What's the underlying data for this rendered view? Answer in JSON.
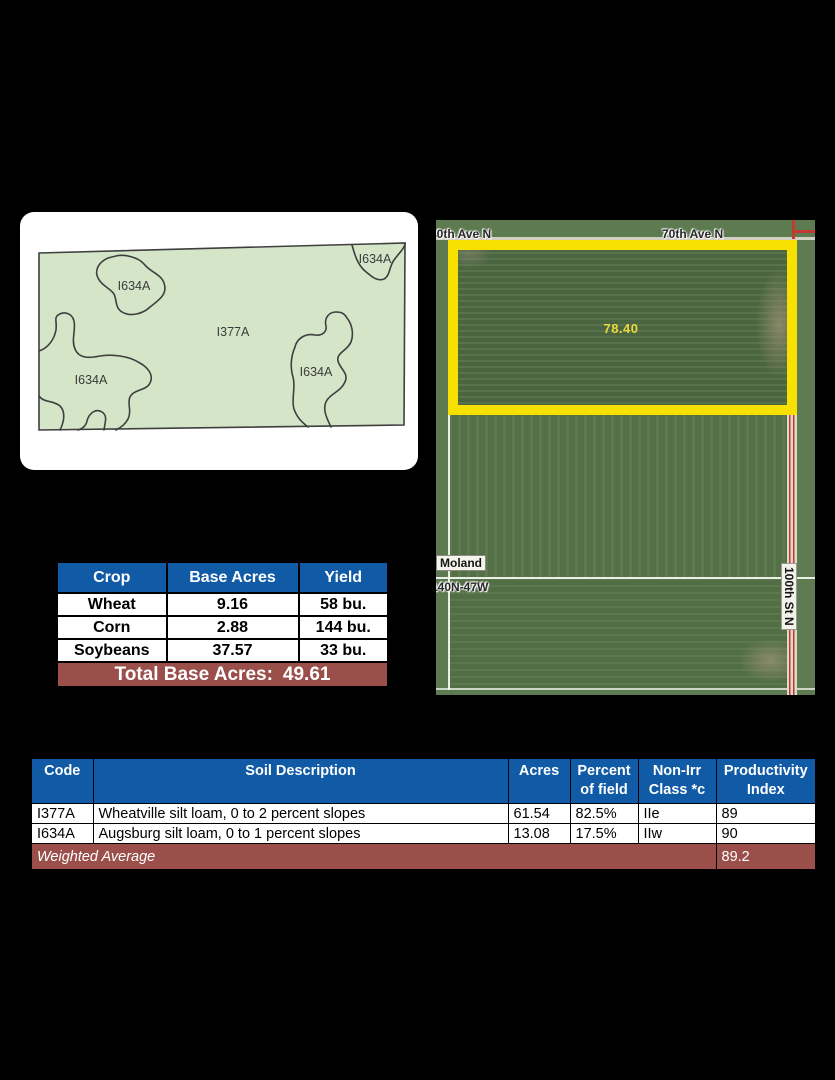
{
  "soil_map": {
    "labels": {
      "top_left": "I634A",
      "top_right": "I634A",
      "center": "I377A",
      "right": "I634A",
      "bottom_left": "I634A"
    },
    "fill_color": "#d5e6c8"
  },
  "aerial_map": {
    "highlighted_acres": "78.40",
    "road_label_top_left": "70th Ave N",
    "road_label_top_center": "70th Ave N",
    "road_label_right": "100th St N",
    "place_label": "Moland",
    "township_label": "140N-47W",
    "highlight_color": "#f8e000",
    "acres_text_color": "#ead93c"
  },
  "crop_table": {
    "headers": [
      "Crop",
      "Base Acres",
      "Yield"
    ],
    "rows": [
      [
        "Wheat",
        "9.16",
        "58 bu."
      ],
      [
        "Corn",
        "2.88",
        "144 bu."
      ],
      [
        "Soybeans",
        "37.57",
        "33 bu."
      ]
    ],
    "footer_label": "Total Base Acres:",
    "footer_value": "49.61"
  },
  "soil_table": {
    "headers": [
      "Code",
      "Soil Description",
      "Acres",
      "Percent of field",
      "Non-Irr Class *c",
      "Productivity Index"
    ],
    "rows": [
      [
        "I377A",
        "Wheatville silt loam, 0 to 2 percent slopes",
        "61.54",
        "82.5%",
        "IIe",
        "89"
      ],
      [
        "I634A",
        "Augsburg silt loam, 0 to 1 percent slopes",
        "13.08",
        "17.5%",
        "IIw",
        "90"
      ]
    ],
    "footer_label": "Weighted Average",
    "footer_value": "89.2"
  },
  "colors": {
    "table_header_blue": "#115aa6",
    "table_footer_maroon": "#9a4f4b",
    "map_fill_green": "#d5e6c8",
    "highlight_yellow": "#f8e000"
  }
}
